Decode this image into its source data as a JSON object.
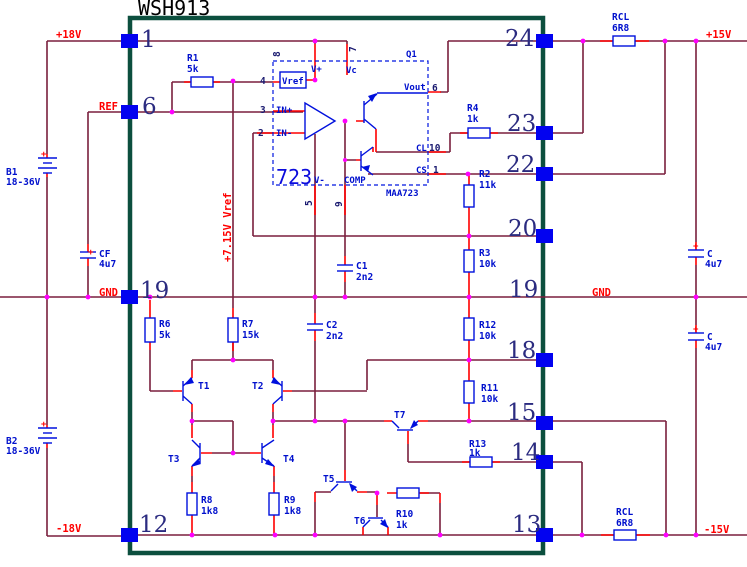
{
  "title": "WSH913",
  "colors": {
    "frame": "#0c4f3e",
    "wire": "#7a1f3d",
    "stub": "#ff0000",
    "component": "#0010dd",
    "node": "#ff00ff",
    "pin_square": "#0202f0",
    "pin_number": "#2b2b80",
    "net_label": "#ff0000"
  },
  "nets": {
    "p18": "+18V",
    "ref": "REF",
    "gnd_left": "GND",
    "gnd_right": "GND",
    "n18": "-18V",
    "p15": "+15V",
    "n15": "-15V",
    "vref_rail": "+7.15V Vref"
  },
  "frame_pins_left": [
    {
      "number": "1"
    },
    {
      "number": "6"
    },
    {
      "number": "19"
    },
    {
      "number": "12"
    }
  ],
  "frame_pins_right": [
    {
      "number": "24"
    },
    {
      "number": "23"
    },
    {
      "number": "22"
    },
    {
      "number": "20"
    },
    {
      "number": "19"
    },
    {
      "number": "18"
    },
    {
      "number": "15"
    },
    {
      "number": "14"
    },
    {
      "number": "13"
    }
  ],
  "ic": {
    "designator": "Q1",
    "big_label": "723",
    "part": "MAA723",
    "vref_block": "Vref",
    "pins": {
      "p4": "4",
      "p3": "3",
      "p2": "2",
      "p8": "8",
      "p7": "7",
      "p6": "6",
      "p10": "10",
      "p1": "1",
      "p5": "5",
      "p9": "9"
    },
    "pin_names": {
      "vplus": "V+",
      "vc": "Vc",
      "vout": "Vout",
      "cl": "CL",
      "cs": "CS",
      "vminus": "V-",
      "comp": "COMP",
      "inp": "IN+",
      "inn": "IN-"
    }
  },
  "batteries": {
    "b1": {
      "name": "B1",
      "value": "18-36V"
    },
    "b2": {
      "name": "B2",
      "value": "18-36V"
    }
  },
  "capacitors": {
    "cf": {
      "name": "CF",
      "value": "4u7"
    },
    "c1": {
      "name": "C1",
      "value": "2n2"
    },
    "c2": {
      "name": "C2",
      "value": "2n2"
    },
    "c_top": {
      "name": "C",
      "value": "4u7"
    },
    "c_bot": {
      "name": "C",
      "value": "4u7"
    }
  },
  "resistors": {
    "r1": {
      "name": "R1",
      "value": "5k"
    },
    "r2": {
      "name": "R2",
      "value": "11k"
    },
    "r3": {
      "name": "R3",
      "value": "10k"
    },
    "r4": {
      "name": "R4",
      "value": "1k"
    },
    "r6": {
      "name": "R6",
      "value": "5k"
    },
    "r7": {
      "name": "R7",
      "value": "15k"
    },
    "r8": {
      "name": "R8",
      "value": "1k8"
    },
    "r9": {
      "name": "R9",
      "value": "1k8"
    },
    "r10": {
      "name": "R10",
      "value": "1k"
    },
    "r11": {
      "name": "R11",
      "value": "10k"
    },
    "r12": {
      "name": "R12",
      "value": "10k"
    },
    "r13": {
      "name": "R13",
      "value": "1k"
    },
    "rcl_top": {
      "name": "RCL",
      "value": "6R8"
    },
    "rcl_bot": {
      "name": "RCL",
      "value": "6R8"
    }
  },
  "transistors": {
    "t1": "T1",
    "t2": "T2",
    "t3": "T3",
    "t4": "T4",
    "t5": "T5",
    "t6": "T6",
    "t7": "T7"
  },
  "plus": "+"
}
